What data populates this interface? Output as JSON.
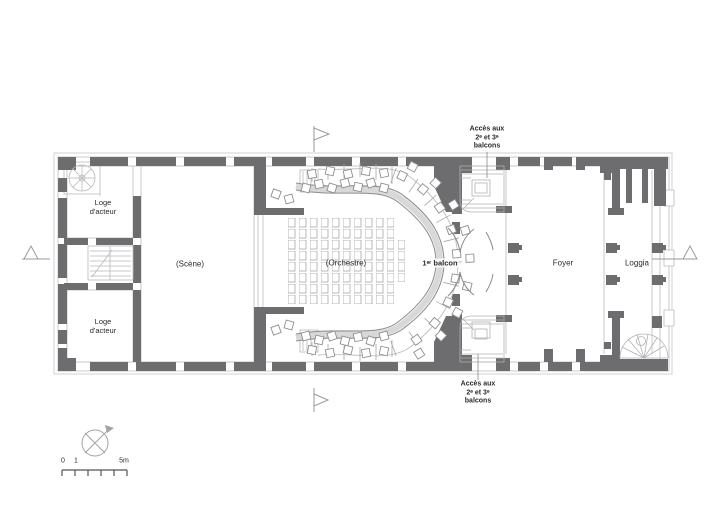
{
  "plan": {
    "title_hint": "theatre-floor-plan",
    "rooms": {
      "loge_top": {
        "line1": "Loge",
        "line2": "d'acteur"
      },
      "loge_bottom": {
        "line1": "Loge",
        "line2": "d'acteur"
      },
      "scene": "(Scène)",
      "orchestre": "(Orchestre)",
      "balcon": "1ᵉʳ balcon",
      "foyer": "Foyer",
      "loggia": "Loggia"
    },
    "annotations": {
      "acces_top": {
        "line1": "Accès aux",
        "line2": "2ᵉ et 3ᵉ",
        "line3": "balcons"
      },
      "acces_bottom": {
        "line1": "Accès aux",
        "line2": "2ᵉ et 3ᵉ",
        "line3": "balcons"
      }
    },
    "scale_bar": {
      "zero": "0",
      "one": "1",
      "five": "5m"
    },
    "colors": {
      "wall": "#6d6d6f",
      "line_light": "#c4c4c6",
      "line_mid": "#9a9a9c",
      "text": "#2b2b2b"
    },
    "icons": {
      "north_arrow": "north-arrow-icon",
      "flag_top": "flag-marker-icon",
      "flag_bottom": "flag-marker-icon",
      "section_left": "section-marker-icon",
      "section_right": "section-marker-icon"
    }
  }
}
